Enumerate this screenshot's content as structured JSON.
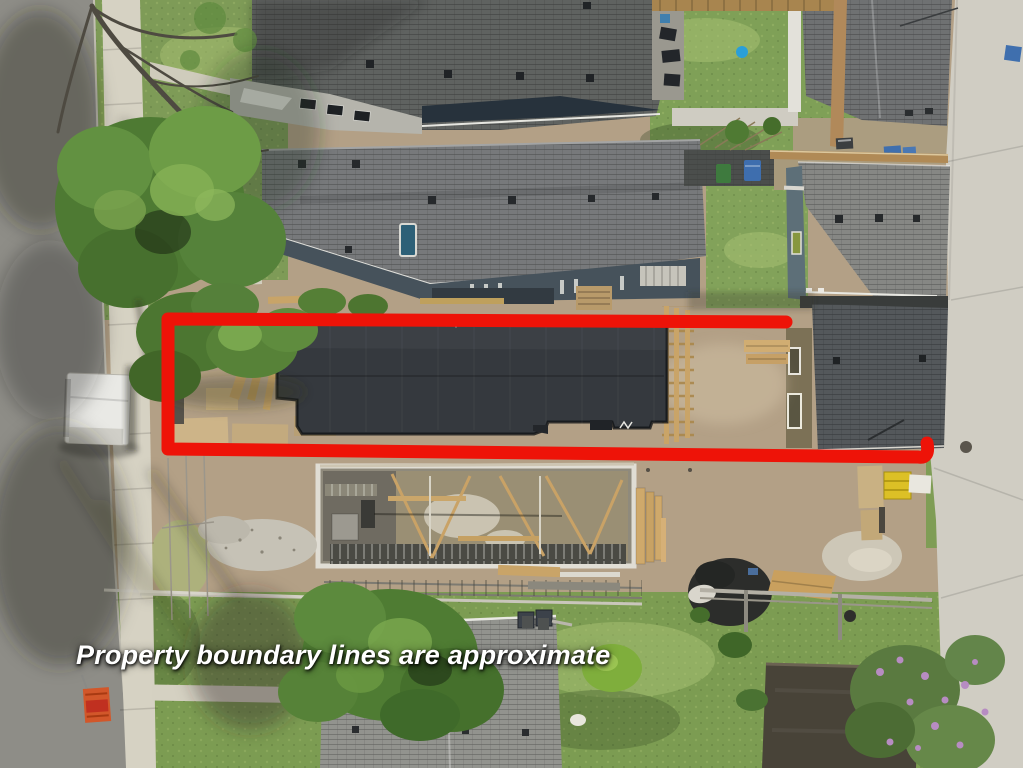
{
  "overlay": {
    "caption": "Property boundary lines are approximate"
  },
  "colors": {
    "boundary": "#ee1308",
    "caption": "#ffffff"
  }
}
